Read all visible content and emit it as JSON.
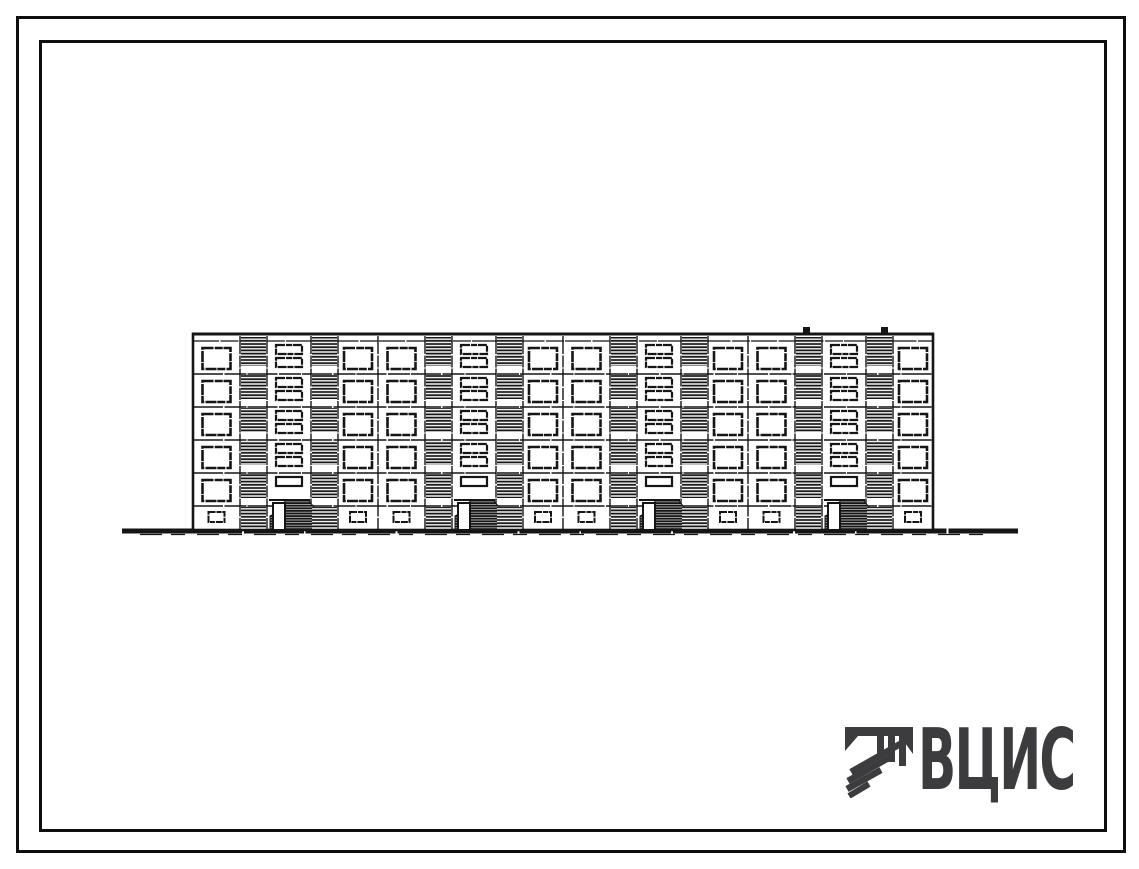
{
  "page": {
    "background": "#ffffff",
    "ink_color": "#151515",
    "description": "Scanned album sheet of a Soviet standard-design project: street facade elevation of a five-storey large-panel apartment building"
  },
  "frame": {
    "color": "#0e0e0e"
  },
  "logo": {
    "text": "ВЦИС",
    "color": "#3c3c3e",
    "icon": "vcis-emblem-icon"
  },
  "drawing": {
    "subject": "Five-storey four-section large-panel apartment building, main facade elevation",
    "counts": {
      "floors": 5,
      "sections": 4,
      "entrances": 4
    },
    "geometry": {
      "left": 193,
      "top": 334,
      "band_bottom": 341,
      "floor_height": 33,
      "floors": 5,
      "bottom": 530,
      "sections": 4,
      "section_columns": [
        {
          "type": "window",
          "w": 47
        },
        {
          "type": "panel",
          "w": 27
        },
        {
          "type": "staircase",
          "w": 44
        },
        {
          "type": "panel",
          "w": 27
        },
        {
          "type": "window",
          "w": 40
        }
      ],
      "window": {
        "w": 28,
        "h": 21,
        "dy": 7
      },
      "basement_window": {
        "w": 16,
        "h": 10,
        "dy": 6
      },
      "slot": {
        "w": 26,
        "h": 9,
        "dy1": 4,
        "dy2": 17
      },
      "door": {
        "w": 12
      },
      "ground": {
        "x1": 122,
        "x2": 1018,
        "y": 531,
        "stroke": 5
      },
      "roof_vents": [
        806,
        884
      ]
    }
  }
}
